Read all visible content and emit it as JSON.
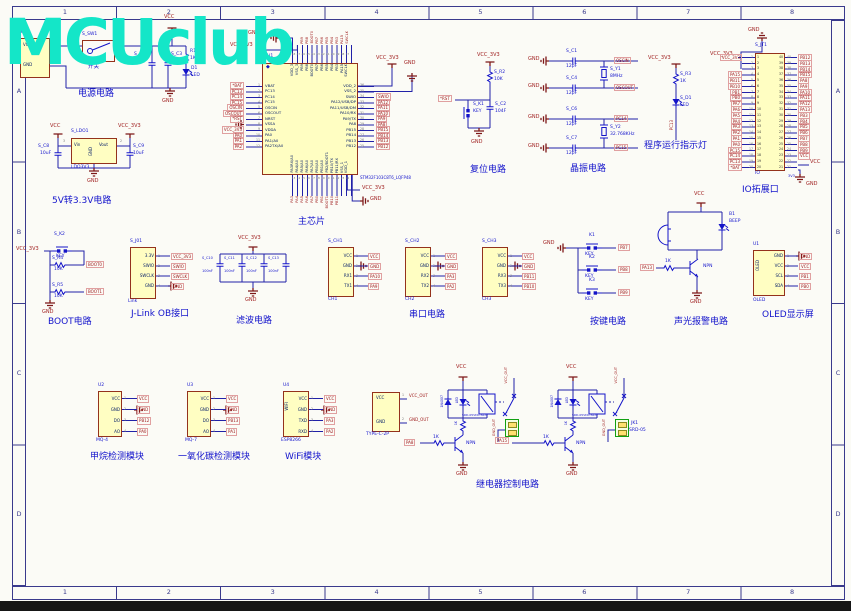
{
  "watermark": "MCUclub",
  "frame": {
    "cols": [
      "1",
      "2",
      "3",
      "4",
      "5",
      "6",
      "7",
      "8"
    ],
    "rows": [
      "A",
      "B",
      "C",
      "D"
    ]
  },
  "power": {
    "caption": "电源电路",
    "t1_ref": "T1",
    "t1_p1": "VCC",
    "t1_p2": "GND",
    "n1": "1",
    "n2": "2",
    "sw_ref": "S_SW1",
    "sw_label": "开关",
    "r_ref": "R1",
    "r_val": "1K",
    "c1_ref": "S_C2",
    "c1_val": "104",
    "c2_ref": "S_C3",
    "c2_val": "10uF",
    "d_ref": "D1",
    "d_val": "LED",
    "vcc": "VCC",
    "gnd": "GND"
  },
  "ldo": {
    "caption": "5V转3.3V电路",
    "ref": "S_LDO1",
    "val": "LDO3V3",
    "p_in": "Vin",
    "p_out": "Vout",
    "p_gnd": "GND",
    "n3": "3",
    "n2": "2",
    "cl_ref": "S_C8",
    "cl_val": "10uF",
    "cr_ref": "S_C9",
    "cr_val": "10uF",
    "vcc": "VCC",
    "vcc3": "VCC_3V3",
    "gnd": "GND"
  },
  "chip": {
    "caption": "主芯片",
    "ref": "S_U1",
    "part": "STM32F103C8T6_LQFP48",
    "vcc3": "VCC_3V3",
    "gnd": "GND",
    "left": [
      {
        "n": "1",
        "name": "VBAT",
        "net": "*BAT"
      },
      {
        "n": "2",
        "name": "PC13",
        "net": "PC13"
      },
      {
        "n": "3",
        "name": "PC14",
        "net": "PC14"
      },
      {
        "n": "4",
        "name": "PC15",
        "net": "PC15"
      },
      {
        "n": "5",
        "name": "OSCIN",
        "net": "OSCIN"
      },
      {
        "n": "6",
        "name": "OSCOUT",
        "net": "OSCOUT"
      },
      {
        "n": "7",
        "name": "NRST",
        "net": "*RST"
      },
      {
        "n": "8",
        "name": "VSSA",
        "net": ""
      },
      {
        "n": "9",
        "name": "VDDA",
        "net": "VCC_3V3"
      },
      {
        "n": "10",
        "name": "PA0",
        "net": "PA0"
      },
      {
        "n": "11",
        "name": "PA1/A0",
        "net": "PA1"
      },
      {
        "n": "12",
        "name": "PA2TX/A0",
        "net": "PA2"
      }
    ],
    "right": [
      {
        "n": "36",
        "name": "VDD_2",
        "net": ""
      },
      {
        "n": "35",
        "name": "VSS_2",
        "net": ""
      },
      {
        "n": "34",
        "name": "SWIO",
        "net": "SWIO"
      },
      {
        "n": "33",
        "name": "PA12/USB/DP",
        "net": "PA12"
      },
      {
        "n": "32",
        "name": "PA11/USB/DM",
        "net": "PA11"
      },
      {
        "n": "31",
        "name": "PA10/RX",
        "net": "PA10"
      },
      {
        "n": "30",
        "name": "PA9/TX",
        "net": "PA9"
      },
      {
        "n": "29",
        "name": "PA8",
        "net": "PA8"
      },
      {
        "n": "28",
        "name": "PB15",
        "net": "PB15"
      },
      {
        "n": "27",
        "name": "PB14",
        "net": "PB14"
      },
      {
        "n": "26",
        "name": "PB13",
        "net": "PB13"
      },
      {
        "n": "25",
        "name": "PB12",
        "net": "PB12"
      }
    ],
    "top": [
      {
        "n": "48",
        "name": "VDD_3"
      },
      {
        "n": "47",
        "name": "VSS_3"
      },
      {
        "n": "46",
        "name": "PB9"
      },
      {
        "n": "45",
        "name": "PB8"
      },
      {
        "n": "44",
        "name": "BOOT0"
      },
      {
        "n": "43",
        "name": "PB7"
      },
      {
        "n": "42",
        "name": "PB6"
      },
      {
        "n": "41",
        "name": "PB5"
      },
      {
        "n": "40",
        "name": "PB4"
      },
      {
        "n": "39",
        "name": "PB3"
      },
      {
        "n": "38",
        "name": "PA15"
      },
      {
        "n": "37",
        "name": "SWCLK"
      }
    ],
    "top_nets": [
      "PB9",
      "PB8",
      "BOOT0",
      "PB7",
      "PB6",
      "PB5",
      "PB4",
      "PB3",
      "PA15",
      "SWCLK"
    ],
    "bottom": [
      {
        "n": "13",
        "name": "PA3RX/A0"
      },
      {
        "n": "14",
        "name": "PA4/A0"
      },
      {
        "n": "15",
        "name": "PA5/A0"
      },
      {
        "n": "16",
        "name": "PA6/A0"
      },
      {
        "n": "17",
        "name": "PA7/A0"
      },
      {
        "n": "18",
        "name": "PB0/A0"
      },
      {
        "n": "19",
        "name": "PB1/A0"
      },
      {
        "n": "20",
        "name": "PB2/BOOT1"
      },
      {
        "n": "21",
        "name": "PB10/TX"
      },
      {
        "n": "22",
        "name": "PB11/RX"
      },
      {
        "n": "23",
        "name": "VSS_1"
      },
      {
        "n": "24",
        "name": "VDD_1"
      }
    ],
    "bottom_nets": [
      "PA3",
      "PA4",
      "PA5",
      "PA6",
      "PA7",
      "PB0",
      "PB1",
      "BOOT1",
      "PB10",
      "PB11"
    ]
  },
  "reset": {
    "caption": "复位电路",
    "vcc3": "VCC_3V3",
    "r_ref": "S_R2",
    "r_val": "10K",
    "rst": "*RST",
    "k_ref": "S_K1",
    "k_val": "KEY",
    "c_ref": "S_C2",
    "c_val": "104F",
    "gnd": "GND"
  },
  "xtal": {
    "caption": "晶振电路",
    "gnd": "GND",
    "rows": [
      {
        "ref": "S_C1",
        "val": "12pF",
        "net": "OSCIN"
      },
      {
        "ref": "S_C4",
        "val": "12pF",
        "net": "OSCOUT"
      },
      {
        "ref": "S_C6",
        "val": "12pF",
        "net": "PC14"
      },
      {
        "ref": "S_C7",
        "val": "12pF",
        "net": "PC15"
      }
    ],
    "y1_ref": "S_Y1",
    "y1_val": "8MHz",
    "y2_ref": "S_Y2",
    "y2_val": "32.768KHz"
  },
  "runled": {
    "caption": "程序运行指示灯",
    "vcc3": "VCC_3V3",
    "r_ref": "S_R3",
    "r_val": "1K",
    "d_ref": "S_D1",
    "d_val": "LED",
    "net": "PC13"
  },
  "io": {
    "caption": "IO拓展口",
    "ref": "S_JT1",
    "name": "IO",
    "gnd": "GND",
    "vcc3": "VCC_3V3",
    "vcc": "VCC",
    "v33": "3V3",
    "left": [
      {
        "n": "1",
        "net": "VCC_3V3"
      },
      {
        "n": "2",
        "net": ""
      },
      {
        "n": "3",
        "net": ""
      },
      {
        "n": "4",
        "net": "PA15"
      },
      {
        "n": "5",
        "net": "PB11"
      },
      {
        "n": "6",
        "net": "PB10"
      },
      {
        "n": "7",
        "net": "PB1"
      },
      {
        "n": "8",
        "net": "PB0"
      },
      {
        "n": "9",
        "net": "PA7"
      },
      {
        "n": "10",
        "net": "PA6"
      },
      {
        "n": "11",
        "net": "PA5"
      },
      {
        "n": "12",
        "net": "PA4"
      },
      {
        "n": "13",
        "net": "PA3"
      },
      {
        "n": "14",
        "net": "PA2"
      },
      {
        "n": "15",
        "net": "PA1"
      },
      {
        "n": "16",
        "net": "PA0"
      },
      {
        "n": "17",
        "net": "PC15"
      },
      {
        "n": "18",
        "net": "PC14"
      },
      {
        "n": "19",
        "net": "PC13"
      },
      {
        "n": "20",
        "net": "*BAT"
      }
    ],
    "right": [
      {
        "n": "40",
        "net": "PB12"
      },
      {
        "n": "39",
        "net": "PB13"
      },
      {
        "n": "38",
        "net": "PB14"
      },
      {
        "n": "37",
        "net": "PB15"
      },
      {
        "n": "36",
        "net": "PA8"
      },
      {
        "n": "35",
        "net": "PA9"
      },
      {
        "n": "34",
        "net": "PA10"
      },
      {
        "n": "33",
        "net": "PA11"
      },
      {
        "n": "32",
        "net": "PA12"
      },
      {
        "n": "31",
        "net": "PA13"
      },
      {
        "n": "30",
        "net": "PB3"
      },
      {
        "n": "29",
        "net": "PB4"
      },
      {
        "n": "28",
        "net": "PB5"
      },
      {
        "n": "27",
        "net": "PB6"
      },
      {
        "n": "26",
        "net": "PB7"
      },
      {
        "n": "25",
        "net": "PB8"
      },
      {
        "n": "24",
        "net": "PB9"
      },
      {
        "n": "23",
        "net": "VCC"
      },
      {
        "n": "22",
        "net": ""
      },
      {
        "n": "21",
        "net": ""
      }
    ]
  },
  "boot": {
    "caption": "BOOT电路",
    "vcc3": "VCC_3V3",
    "k_ref": "S_K2",
    "k_val": "KEY",
    "r1_ref": "S_R4",
    "r1_val": "10K",
    "net1": "BOOT0",
    "r2_ref": "S_R5",
    "r2_val": "10K",
    "net2": "BOOT1",
    "gnd": "GND"
  },
  "jlink": {
    "caption": "J-Link OB接口",
    "ref": "S_J01",
    "label": "Link",
    "pins": [
      {
        "name": "3.3V",
        "n": "1",
        "net": "VCC_3V3"
      },
      {
        "name": "SWIO",
        "n": "2",
        "net": "SWIO"
      },
      {
        "name": "SWCLK",
        "n": "3",
        "net": "SWCLK"
      },
      {
        "name": "GND",
        "n": "4",
        "net": "GND"
      }
    ]
  },
  "filter": {
    "caption": "滤波电路",
    "vcc3": "VCC_3V3",
    "gnd": "GND",
    "caps": [
      {
        "ref": "S_C10",
        "val": "100nF"
      },
      {
        "ref": "S_C11",
        "val": "100nF"
      },
      {
        "ref": "S_C12",
        "val": "100nF"
      },
      {
        "ref": "S_C13",
        "val": "100nF"
      }
    ]
  },
  "serial": {
    "caption": "串口电路",
    "c1": {
      "ref": "S_CH1",
      "label": "CH1",
      "pins": [
        {
          "name": "VCC",
          "n": "1",
          "net": "VCC"
        },
        {
          "name": "GND",
          "n": "2",
          "net": "GND"
        },
        {
          "name": "RX1",
          "n": "3",
          "net": "PA10"
        },
        {
          "name": "TX1",
          "n": "4",
          "net": "PA9"
        }
      ]
    },
    "c2": {
      "ref": "S_CH2",
      "label": "CH2",
      "pins": [
        {
          "name": "VCC",
          "n": "1",
          "net": "VCC"
        },
        {
          "name": "GND",
          "n": "2",
          "net": "GND"
        },
        {
          "name": "RX2",
          "n": "3",
          "net": "PA3"
        },
        {
          "name": "TX2",
          "n": "4",
          "net": "PA2"
        }
      ]
    },
    "c3": {
      "ref": "S_CH3",
      "label": "CH3",
      "pins": [
        {
          "name": "VCC",
          "n": "1",
          "net": "VCC"
        },
        {
          "name": "GND",
          "n": "2",
          "net": "GND"
        },
        {
          "name": "RX3",
          "n": "3",
          "net": "PB11"
        },
        {
          "name": "TX3",
          "n": "4",
          "net": "PB10"
        }
      ]
    }
  },
  "keys": {
    "caption": "按键电路",
    "gnd": "GND",
    "items": [
      {
        "ref": "K1",
        "val": "KEY",
        "net": "PB7"
      },
      {
        "ref": "K2",
        "val": "KEY",
        "net": "PB8"
      },
      {
        "ref": "K3",
        "val": "KEY",
        "net": "PB9"
      }
    ]
  },
  "alarm": {
    "caption": "声光报警电路",
    "vcc": "VCC",
    "gnd": "GND",
    "r_val": "1K",
    "net": "PA13",
    "q": "NPN",
    "b_ref": "B1",
    "b_val": "BEEP"
  },
  "oled": {
    "caption": "OLED显示屏",
    "ref": "U1",
    "body": "OLED",
    "label": "OLED",
    "pins": [
      {
        "name": "GND",
        "n": "1",
        "net": "GND"
      },
      {
        "name": "VCC",
        "n": "2",
        "net": "VCC"
      },
      {
        "name": "SCL",
        "n": "3",
        "net": "PB1"
      },
      {
        "name": "SDA",
        "n": "4",
        "net": "PB0"
      }
    ]
  },
  "mods": {
    "m1": {
      "caption": "甲烷检测模块",
      "ref": "U2",
      "name": "MQ-4",
      "pins": [
        {
          "name": "VCC",
          "n": "1",
          "net": "VCC"
        },
        {
          "name": "GND",
          "n": "2",
          "net": "GND"
        },
        {
          "name": "DO",
          "n": "3",
          "net": "PB12"
        },
        {
          "name": "AO",
          "n": "4",
          "net": "PA0"
        }
      ]
    },
    "m2": {
      "caption": "一氧化碳检测模块",
      "ref": "U3",
      "name": "MQ-7",
      "pins": [
        {
          "name": "VCC",
          "n": "1",
          "net": "VCC"
        },
        {
          "name": "GND",
          "n": "2",
          "net": "GND"
        },
        {
          "name": "DO",
          "n": "3",
          "net": "PB13"
        },
        {
          "name": "AO",
          "n": "4",
          "net": "PA1"
        }
      ]
    },
    "m3": {
      "caption": "WiFi模块",
      "ref": "U4",
      "body": "WIFI",
      "name": "ESP8266",
      "pins": [
        {
          "name": "VCC",
          "n": "1",
          "net": "VCC"
        },
        {
          "name": "GND",
          "n": "2",
          "net": "GND"
        },
        {
          "name": "TXD",
          "n": "3",
          "net": "PA3"
        },
        {
          "name": "RXD",
          "n": "4",
          "net": "PA2"
        }
      ]
    }
  },
  "relay": {
    "caption": "继电器控制电路",
    "vcc": "VCC",
    "gnd": "GND",
    "d_val": "1N4007",
    "led": "LED",
    "coil_r": "1K",
    "r_val": "1K",
    "q": "NPN",
    "relay_val": "SRD-05VDC-SL-C",
    "u1_net": "PA8",
    "u2_net": "PA15",
    "term_ref": "JK1",
    "term_val": "SRD-05",
    "out_v": "VCC_OUT",
    "out_g": "GND_OUT",
    "tc": {
      "name": "TYPE-C-2P",
      "p1": "VCC",
      "p2": "GND",
      "n1": "VCC_OUT",
      "n2": "GND_OUT",
      "n_1": "1",
      "n_2": "2"
    }
  }
}
